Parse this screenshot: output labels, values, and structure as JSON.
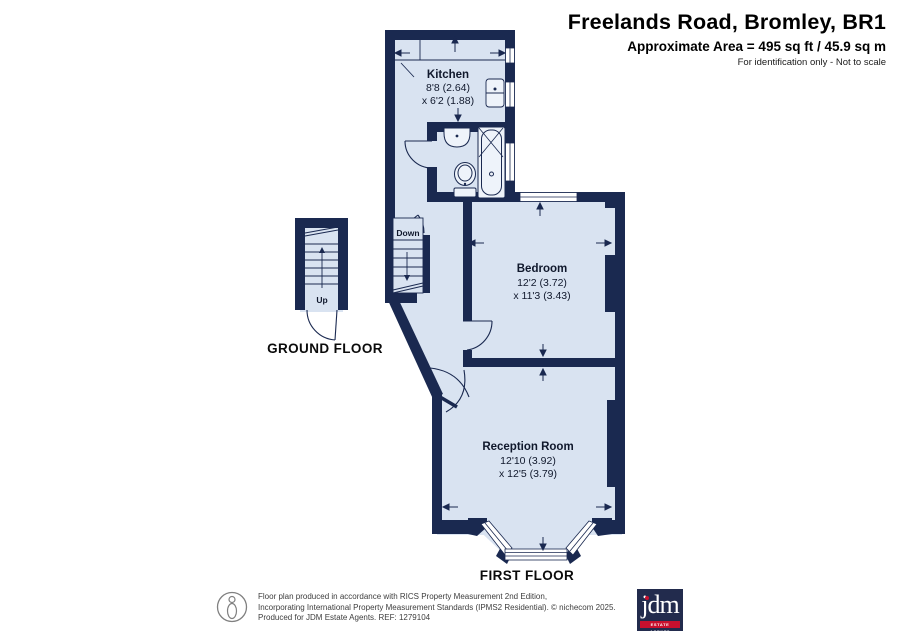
{
  "header": {
    "title": "Freelands Road, Bromley, BR1",
    "area_line": "Approximate Area = 495 sq ft / 45.9 sq m",
    "note_line": "For identification only - Not to scale"
  },
  "plan": {
    "floor_labels": {
      "ground": "GROUND FLOOR",
      "first": "FIRST FLOOR"
    },
    "stairs": {
      "down_label": "Down",
      "up_label": "Up"
    },
    "rooms": [
      {
        "name": "Kitchen",
        "dim1": "8'8 (2.64)",
        "dim2": "x 6'2 (1.88)"
      },
      {
        "name": "Bedroom",
        "dim1": "12'2 (3.72)",
        "dim2": "x 11'3 (3.43)"
      },
      {
        "name": "Reception Room",
        "dim1": "12'10 (3.92)",
        "dim2": "x 12'5 (3.79)"
      }
    ]
  },
  "footer": {
    "disclaimer_line1": "Floor plan produced in accordance with RICS Property Measurement 2nd Edition,",
    "disclaimer_line2": "Incorporating International Property Measurement Standards (IPMS2 Residential).   © nichecom 2025.",
    "disclaimer_line3": "Produced for JDM Estate Agents.   REF: 1279104",
    "logo": {
      "text": "jdm",
      "tagline": "ESTATE AGENTS"
    }
  },
  "colors": {
    "wall_navy": "#1a2950",
    "floor_fill": "#d9e3f1",
    "logo_background": "#222b4d",
    "logo_red": "#c8102e"
  }
}
